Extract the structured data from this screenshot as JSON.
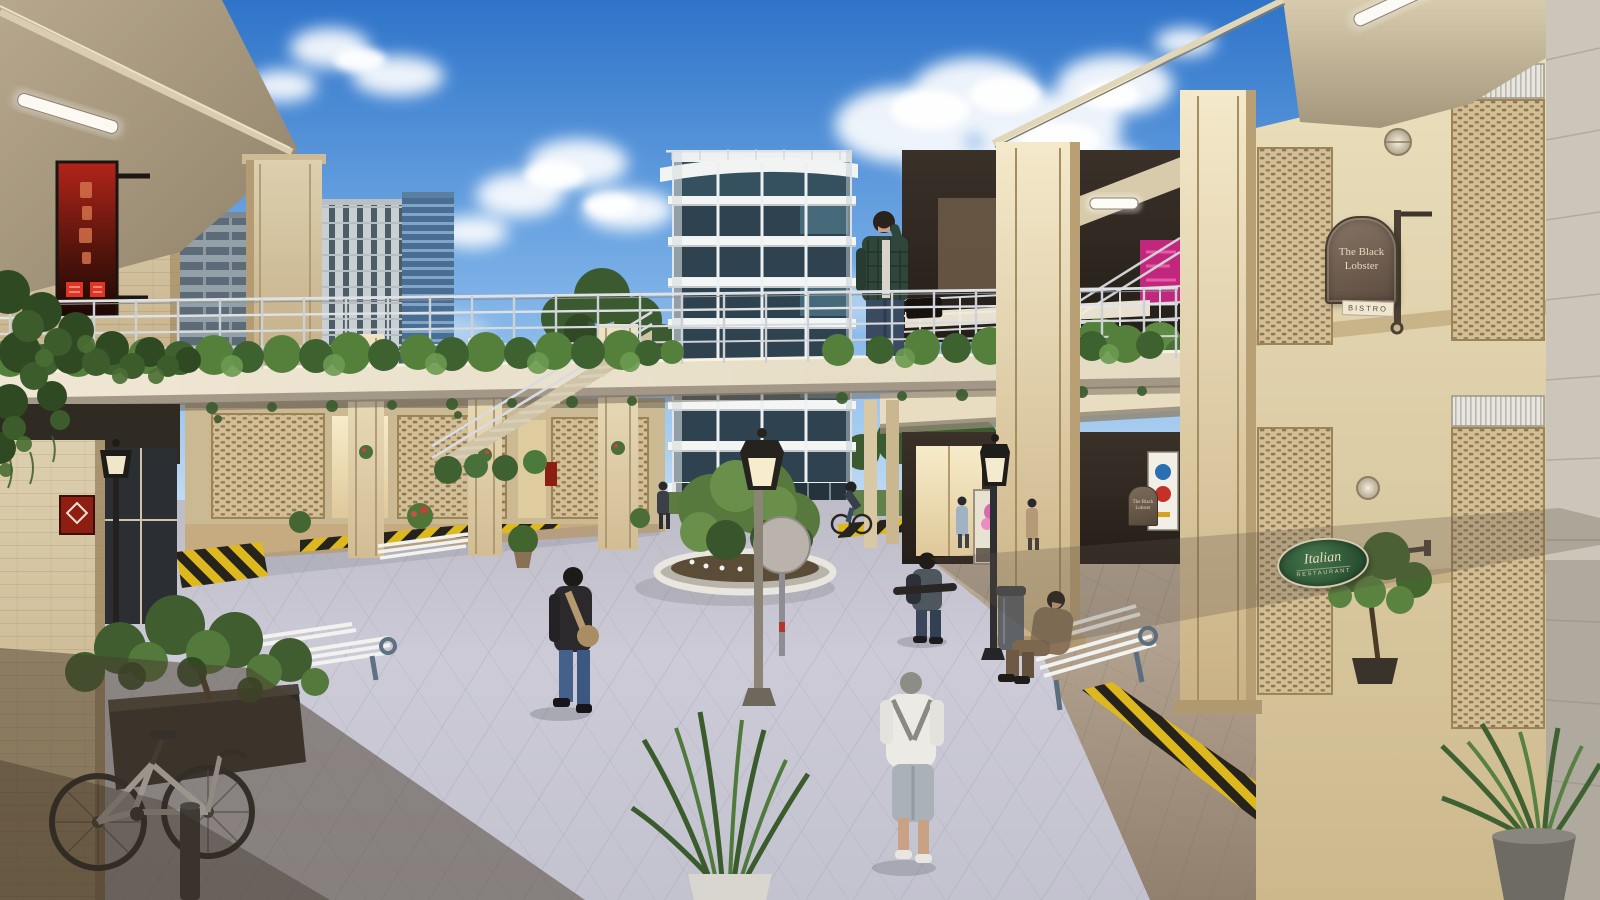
{
  "meta": {
    "kind": "architectural-render",
    "description": "Photoreal 3D rendering of a mixed-use retail plaza courtyard: two-story sandstone arcade buildings joined by a pedestrian bridge with planted hedge, a white residential tower beyond, paved pedestrian plaza with lampposts, benches and people"
  },
  "signs": {
    "bistro": {
      "line1": "The Black",
      "line2": "Lobster",
      "tagline": "BISTRO"
    },
    "italian": {
      "script": "Italian",
      "caps": "RESTAURANT"
    }
  },
  "palette": {
    "sky_top": "#2f74c9",
    "sky_horizon": "#dcebf7",
    "sandstone": "#d8c6a2",
    "cream_column": "#efe3c6",
    "pavement": "#c9c8d4",
    "walkway_tan": "#b3a290",
    "hedge_green": "#4d7036",
    "hazard_yellow": "#ddb91f",
    "red_sign": "#a51f12",
    "pink_sign": "#c2277e",
    "italian_green": "#315c38",
    "lobster_sign": "#77675a",
    "tower_glass": "#2e4250"
  },
  "scene": {
    "objects": [
      "pedestrian-bridge-with-hedge-planters",
      "white-residential-tower",
      "left-retail-arcade",
      "right-retail-arcade-with-mesh-screens",
      "background-city-towers",
      "central-circular-planter",
      "classic-lampposts",
      "white-slat-benches",
      "white-bicycle",
      "hazard-striped-curbs",
      "ivy-covered-corner",
      "potted-plants",
      "trash-bin",
      "round-traffic-sign-back"
    ],
    "people": [
      "man in plaid shirt on bridge talking on phone",
      "man walking with tan sling bag",
      "young man with backpack carrying skateboard",
      "man in white jacket walking away",
      "man in brown coat seated on bench",
      "cyclist near tower",
      "pedestrians by the shops"
    ]
  }
}
